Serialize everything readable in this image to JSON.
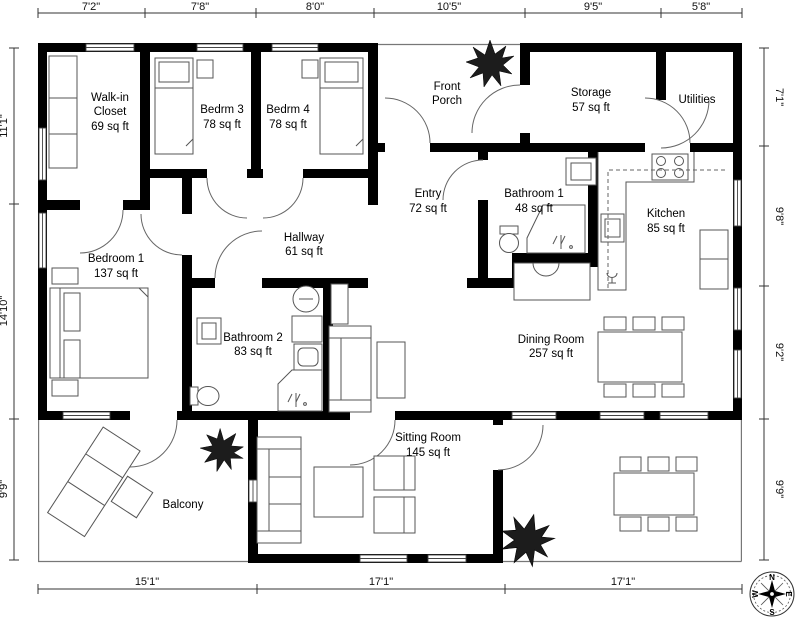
{
  "plan": {
    "rooms": {
      "walk_in_closet": {
        "line1": "Walk-in",
        "line2": "Closet",
        "area": "69 sq ft"
      },
      "bedrm3": {
        "name": "Bedrm 3",
        "area": "78 sq ft"
      },
      "bedrm4": {
        "name": "Bedrm 4",
        "area": "78 sq ft"
      },
      "front_porch": {
        "line1": "Front",
        "line2": "Porch"
      },
      "storage": {
        "name": "Storage",
        "area": "57 sq ft"
      },
      "utilities": {
        "name": "Utilities"
      },
      "entry": {
        "name": "Entry",
        "area": "72 sq ft"
      },
      "bathroom1": {
        "name": "Bathroom 1",
        "area": "48 sq ft"
      },
      "kitchen": {
        "name": "Kitchen",
        "area": "85 sq ft"
      },
      "hallway": {
        "name": "Hallway",
        "area": "61 sq ft"
      },
      "bedroom1": {
        "name": "Bedroom 1",
        "area": "137 sq ft"
      },
      "bathroom2": {
        "name": "Bathroom 2",
        "area": "83 sq ft"
      },
      "dining_room": {
        "name": "Dining Room",
        "area": "257 sq ft"
      },
      "sitting_room": {
        "name": "Sitting Room",
        "area": "145 sq ft"
      },
      "balcony": {
        "name": "Balcony"
      }
    },
    "dimensions": {
      "top": [
        "7'2\"",
        "7'8\"",
        "8'0\"",
        "10'5\"",
        "9'5\"",
        "5'8\""
      ],
      "left": [
        "11'1\"",
        "14'10\"",
        "9'9\""
      ],
      "right": [
        "7'1\"",
        "9'8\"",
        "9'2\"",
        "9'9\""
      ],
      "bottom": [
        "15'1\"",
        "17'1\"",
        "17'1\""
      ]
    },
    "compass": {
      "n": "N",
      "e": "E",
      "s": "S",
      "w": "W"
    },
    "colors": {
      "wall": "#000000",
      "furniture_stroke": "#555555",
      "plant": "#1c1c1c"
    }
  }
}
